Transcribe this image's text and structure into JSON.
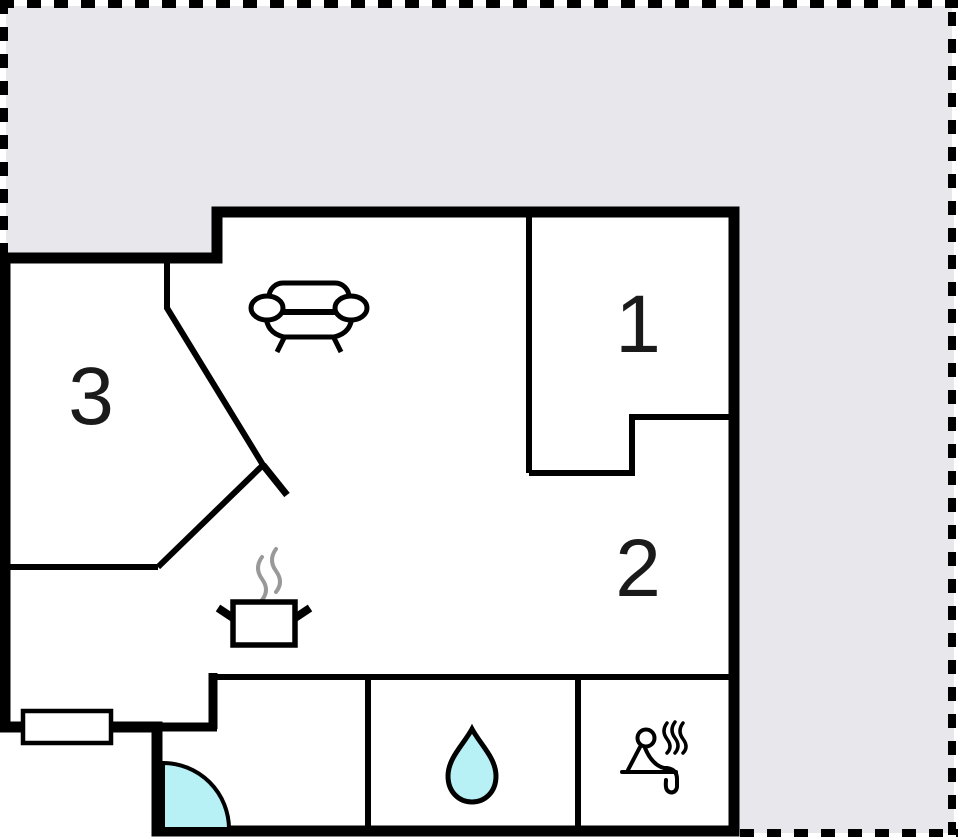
{
  "plan": {
    "type": "floor-plan",
    "rooms": [
      {
        "id": "room-1",
        "label": "1"
      },
      {
        "id": "room-2",
        "label": "2"
      },
      {
        "id": "room-3",
        "label": "3"
      }
    ],
    "icons": [
      {
        "name": "sofa-icon",
        "meaning": "sofa (living room)"
      },
      {
        "name": "stove-icon",
        "meaning": "steaming pot (kitchen)"
      },
      {
        "name": "water-drop-icon",
        "meaning": "water drop (bathroom)"
      },
      {
        "name": "sauna-icon",
        "meaning": "person in sauna"
      },
      {
        "name": "door-swing-icon",
        "meaning": "entrance door swing"
      },
      {
        "name": "window-symbol",
        "meaning": "window"
      }
    ],
    "colors": {
      "plot_background": "#e8e8ec",
      "wall": "#000000",
      "floor": "#ffffff",
      "water": "#b7f0f5",
      "steam": "#999999",
      "boundary": "#000000",
      "label_text": "#1a1a1a"
    }
  }
}
